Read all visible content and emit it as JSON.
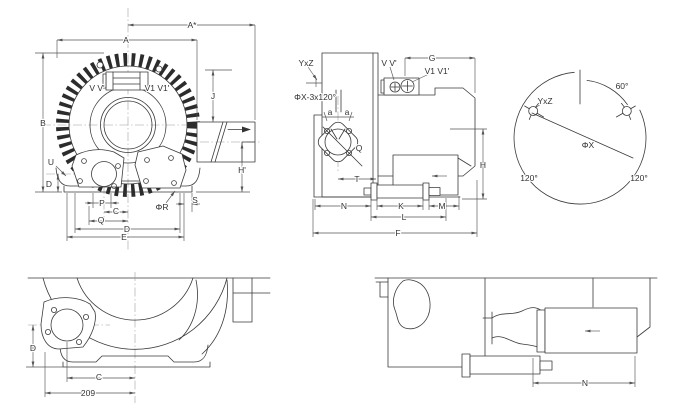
{
  "drawing": {
    "background_color": "#ffffff",
    "line_color": "#3a3a3a",
    "front_view": {
      "dim_a_star": "A*",
      "dim_a": "A",
      "dim_b": "B",
      "dim_u": "U",
      "dim_d_side": "D",
      "dim_j": "J",
      "dim_h_prime": "H'",
      "label_port_v": "V V'",
      "label_port_v1": "V1 V1'",
      "dim_p": "P",
      "dim_c": "C",
      "dim_q": "Q",
      "dim_d": "D",
      "dim_e": "E",
      "dim_phi_r": "ΦR",
      "dim_s": "S"
    },
    "side_view": {
      "label_yxz": "YxZ",
      "label_phix_holes": "ΦX-3x120°",
      "label_port_v": "V V'",
      "label_port_v1": "V1 V1'",
      "dim_g": "G",
      "dim_a_left": "a",
      "dim_a_right": "a",
      "dim_q": "Q",
      "dim_t": "T",
      "dim_n": "N",
      "dim_k": "K",
      "dim_l": "L",
      "dim_m": "M",
      "dim_f": "F",
      "dim_h": "H"
    },
    "bolt_circle_view": {
      "angle_top": "60°",
      "label_yxz": "YxZ",
      "dim_phix": "ΦX",
      "angle_bottom_left": "120°",
      "angle_bottom_right": "120°"
    },
    "bottom_front_view": {
      "dim_d": "D",
      "dim_c": "C",
      "dim_209": "209"
    },
    "bottom_side_view": {
      "dim_n": "N"
    }
  }
}
